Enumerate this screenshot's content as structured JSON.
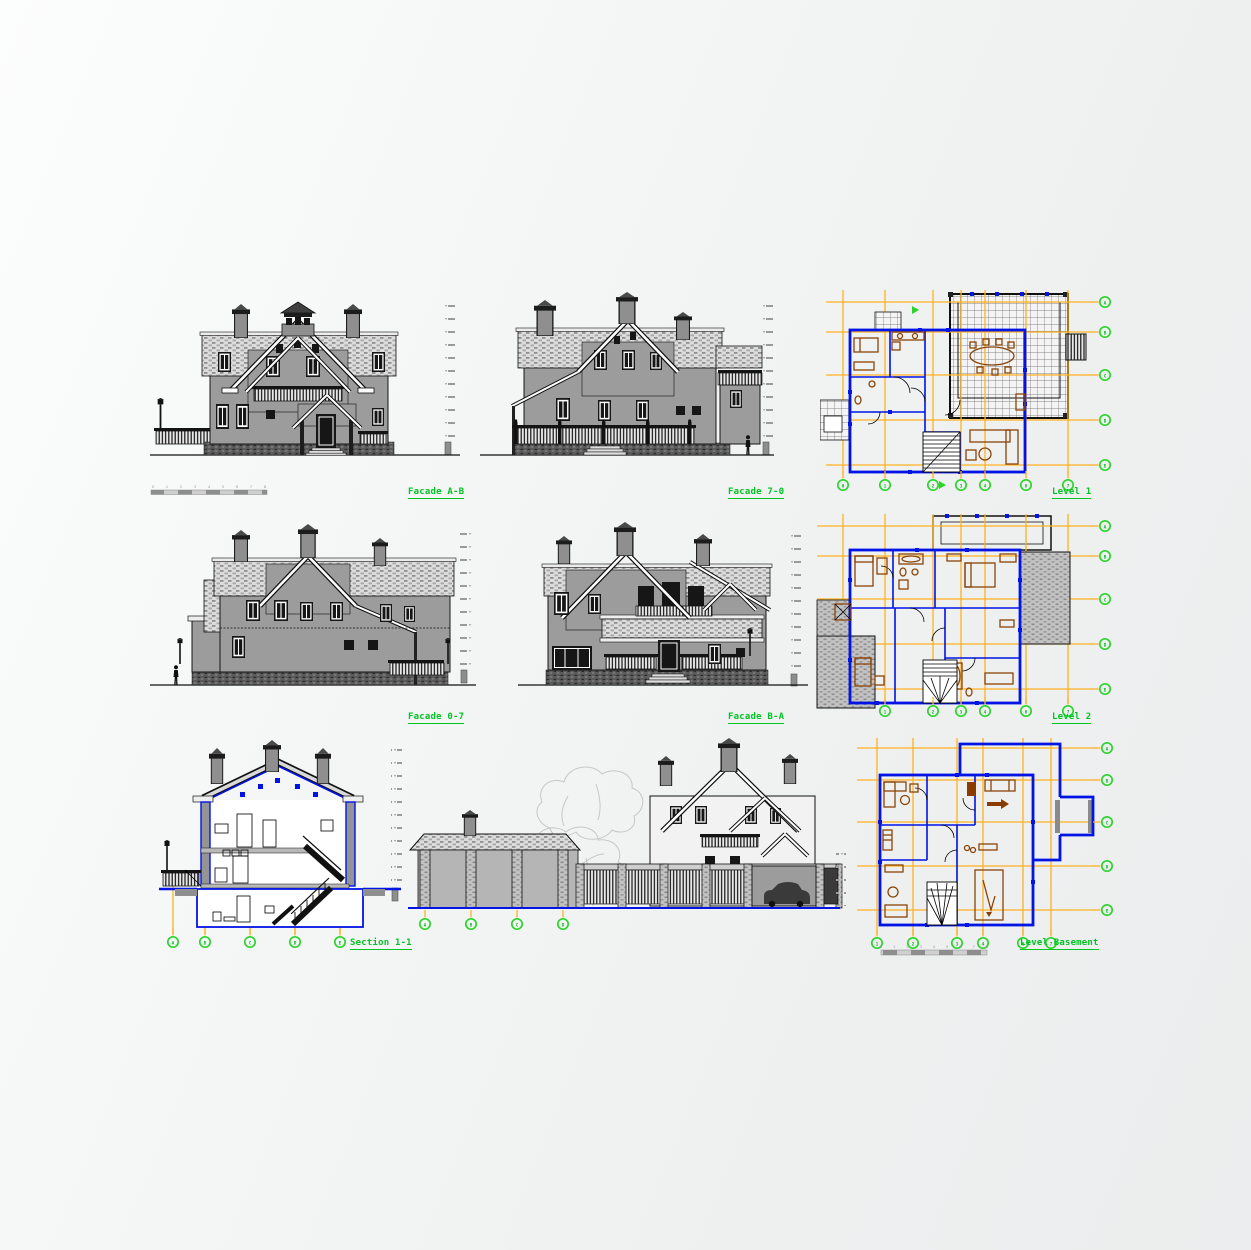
{
  "colors": {
    "label_green": "#00c423",
    "axis_bubble_green": "#2ed32e",
    "grid_orange": "#ffb122",
    "wall_blue": "#0014e6",
    "furniture_brown": "#8a4408",
    "elevation_gray": "#9c9c9c",
    "line_black": "#111111",
    "background": "#f2f4f4"
  },
  "labels": {
    "facade_ab": "Facade A-B",
    "facade_70": "Facade 7-0",
    "facade_07": "Facade 0-7",
    "facade_ba": "Facade B-A",
    "section_11": "Section 1-1",
    "level_1": "Level 1",
    "level_2": "Level 2",
    "level_basement": "Level Basement"
  },
  "axes": {
    "level1_bottom": [
      "0",
      "1",
      "2",
      "3",
      "4",
      "6",
      "7"
    ],
    "level1_right": [
      "A",
      "B",
      "C",
      "D",
      "E"
    ],
    "level2_bottom": [
      "1",
      "2",
      "3",
      "4",
      "6",
      "7"
    ],
    "level2_right": [
      "A",
      "B",
      "C",
      "D",
      "E"
    ],
    "basement_bottom": [
      "1",
      "2",
      "3",
      "4",
      "6",
      "7"
    ],
    "basement_right": [
      "A",
      "B",
      "C",
      "D",
      "E"
    ],
    "section_bottom": [
      "A",
      "B",
      "C",
      "D",
      "E"
    ],
    "garage_bottom": [
      "A",
      "B",
      "C",
      "D"
    ]
  },
  "scalebar": {
    "ticks": [
      "0",
      "1",
      "2",
      "3",
      "4",
      "5",
      "6",
      "7",
      "8"
    ]
  }
}
